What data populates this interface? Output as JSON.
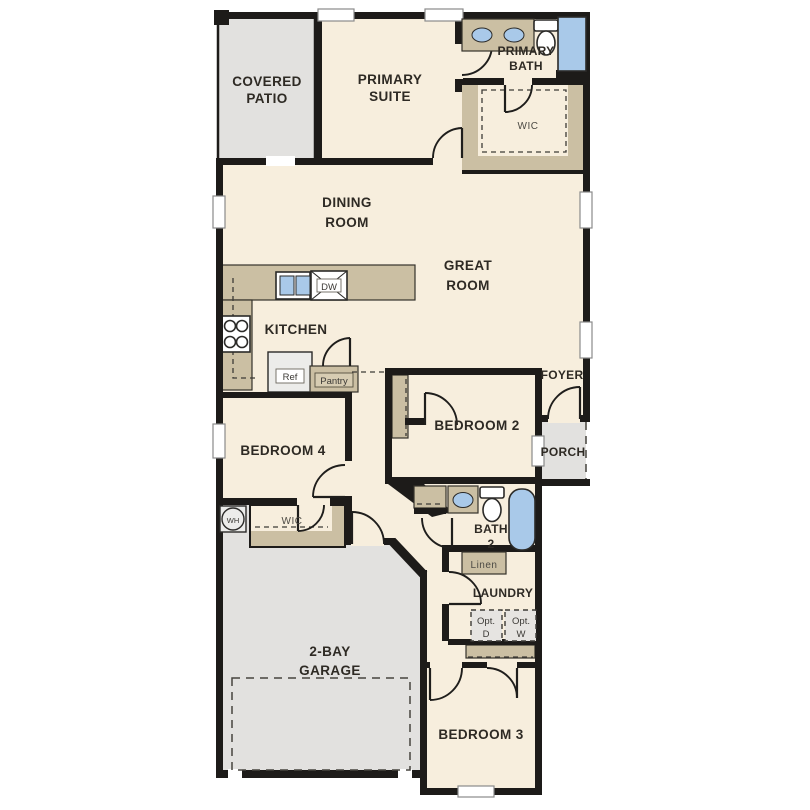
{
  "plan": {
    "rooms": {
      "covered_patio": [
        "COVERED",
        "PATIO"
      ],
      "primary_suite": [
        "PRIMARY",
        "SUITE"
      ],
      "primary_bath": [
        "PRIMARY",
        "BATH"
      ],
      "primary_wic": "WIC",
      "dining": [
        "DINING",
        "ROOM"
      ],
      "great": [
        "GREAT",
        "ROOM"
      ],
      "kitchen": "KITCHEN",
      "foyer": "FOYER",
      "porch": "PORCH",
      "bedroom2": "BEDROOM 2",
      "bedroom4": "BEDROOM 4",
      "bed4_wic": "WIC",
      "bath2": [
        "BATH",
        "2"
      ],
      "linen": "Linen",
      "laundry": "LAUNDRY",
      "garage": [
        "2-BAY",
        "GARAGE"
      ],
      "bedroom3": "BEDROOM 3"
    },
    "fixtures": {
      "ref": "Ref",
      "dw": "DW",
      "pantry": "Pantry",
      "wh": "WH",
      "opt_d": [
        "Opt.",
        "D"
      ],
      "opt_w": [
        "Opt.",
        "W"
      ]
    },
    "colors": {
      "floor": "#f7eedd",
      "outdoor": "#e2e1df",
      "wall": "#1d1b19",
      "cabinet": "#cbbfa3",
      "blue": "#a9c9e9"
    }
  }
}
